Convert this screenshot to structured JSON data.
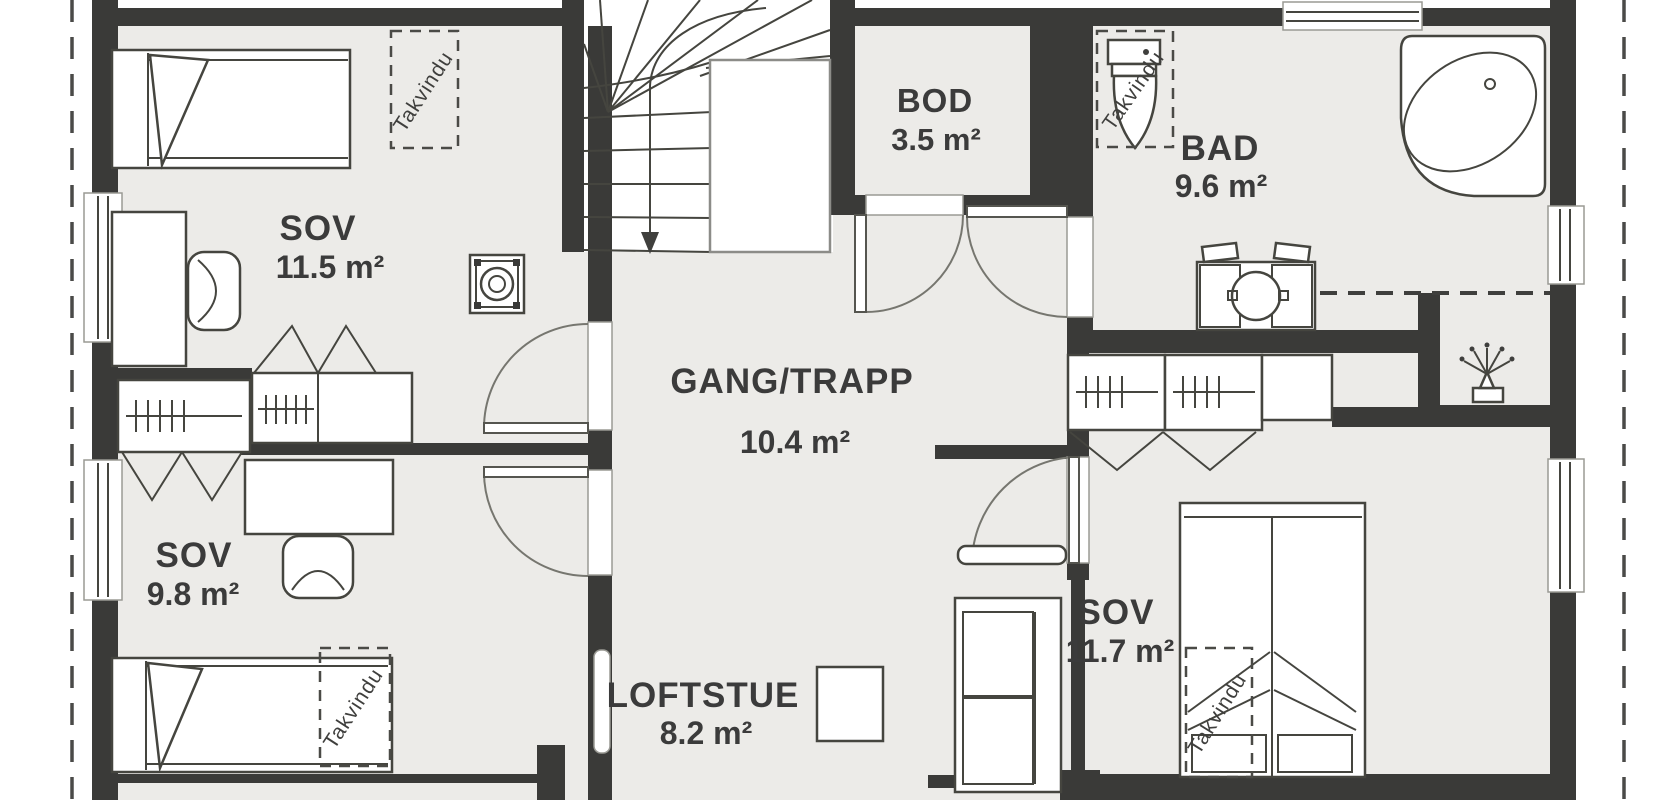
{
  "floorplan": {
    "rooms": [
      {
        "name": "SOV",
        "area": "11.5 m²"
      },
      {
        "name": "SOV",
        "area": "9.8 m²"
      },
      {
        "name": "GANG/TRAPP",
        "area": "10.4 m²"
      },
      {
        "name": "LOFTSTUE",
        "area": "8.2 m²"
      },
      {
        "name": "BOD",
        "area": "3.5 m²"
      },
      {
        "name": "BAD",
        "area": "9.6 m²"
      },
      {
        "name": "SOV",
        "area": "11.7 m²"
      }
    ],
    "skylight_label": "Takvindu",
    "colors": {
      "wall": "#3a3a38",
      "floor": "#ecebe8",
      "furniture_stroke": "#45453f",
      "background": "#ffffff"
    }
  }
}
